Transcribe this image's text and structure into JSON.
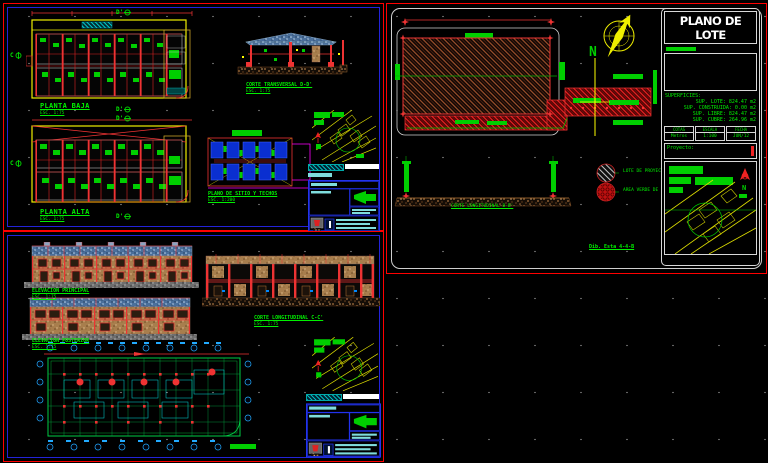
{
  "colors": {
    "background": "#000000",
    "frame_red": "#ff0000",
    "frame_blue": "#2323d8",
    "cad_green": "#00ef00",
    "cad_yellow": "#ffff00",
    "cad_cyan": "#00efef",
    "cad_red": "#ff2020",
    "cad_magenta": "#ff00ff",
    "roof_blue": "#4a6f9b",
    "wall_tan": "#a87e4d",
    "soil_brown": "#9a6a3a"
  },
  "sheet_plantas": {
    "planta_baja_label": "PLANTA BAJA",
    "planta_baja_scale": "ESC. 1:75",
    "planta_alta_label": "PLANTA ALTA",
    "planta_alta_scale": "ESC. 1:75",
    "corte_d_label": "CORTE TRANSVERSAL D-D'",
    "corte_d_scale": "ESC. 1:75",
    "sitio_label": "PLANO DE SITIO Y TECHOS",
    "sitio_scale": "ESC. 1:200",
    "marker_d1": "D'",
    "marker_d2": "D'",
    "marker_d3": "D'",
    "marker_d4": "D'",
    "marker_c1": "C",
    "marker_c2": "C"
  },
  "sheet_elevaciones": {
    "elev_principal_label": "ELEVACION PRINCIPAL",
    "elev_principal_scale": "ESC. 1:75",
    "elev_posterior_label": "ELEVACION POSTERIOR",
    "elev_posterior_scale": "ESC. 1:75",
    "corte_c_label": "CORTE LONGITUDINAL C-C'",
    "corte_c_scale": "ESC. 1:75"
  },
  "plano_lote": {
    "title": "PLANO DE LOTE",
    "superficies_header": "SUPERFICIES:",
    "superficies": [
      "SUP. LOTE: 824.47 m2",
      "SUP. CONSTRUIDA: 0.00 m2",
      "SUP. LIBRE: 824.47 m2",
      "SUP. CUBRE: 264.96 m2"
    ],
    "info_boxes": [
      {
        "label": "COTAS",
        "value": "Metros"
      },
      {
        "label": "ESCALA",
        "value": "1:100"
      },
      {
        "label": "FECHA",
        "value": "JUN/12"
      }
    ],
    "proyecto_label": "Proyecto:",
    "corte_b_label": "CORTE LONGITUDINAL B-B'",
    "legend": [
      {
        "label": "LOTE DE PROYECTO"
      },
      {
        "label": "AREA VERDE DE CESION"
      }
    ],
    "note": "Dib. Esta 4-4-B",
    "compass_letter": "N",
    "north_letter": "N"
  }
}
